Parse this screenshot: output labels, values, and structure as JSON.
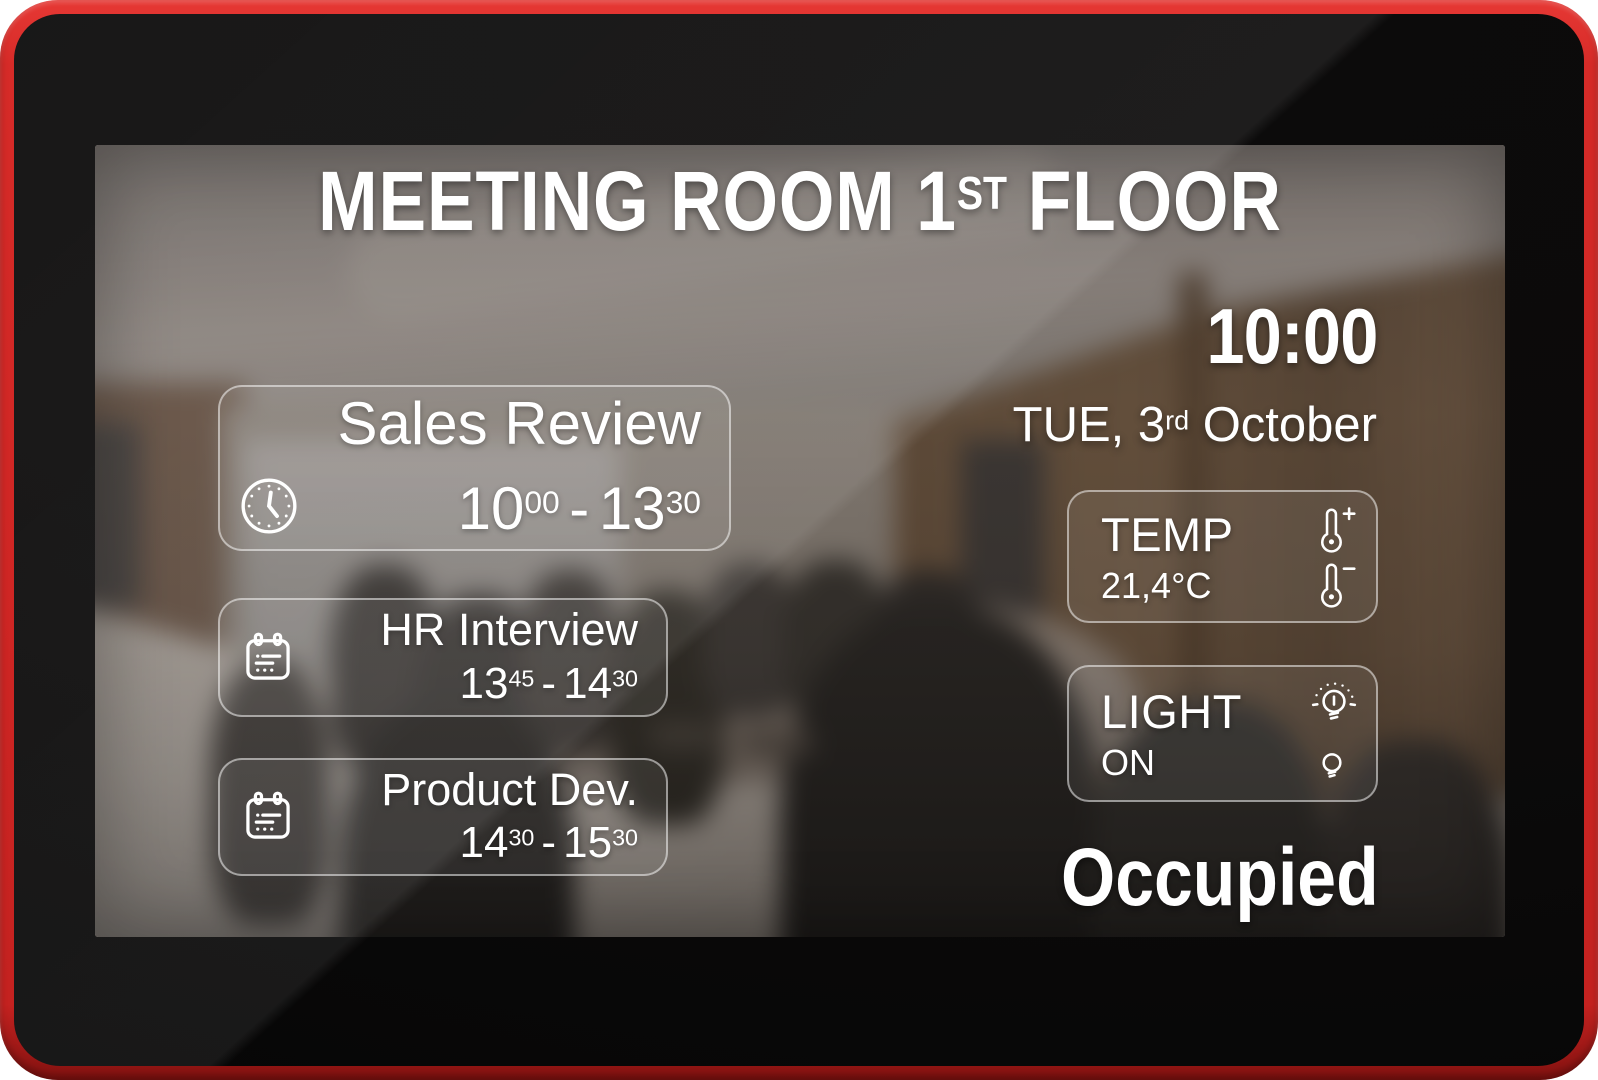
{
  "colors": {
    "frame_red": "#d42b28",
    "bezel_black": "#0b0a0a",
    "text": "#ffffff"
  },
  "header": {
    "title_prefix": "MEETING ROOM 1",
    "title_sup": "ST",
    "title_suffix": " FLOOR"
  },
  "datetime": {
    "time": "10:00",
    "date_prefix": "TUE, 3",
    "date_sup": "rd",
    "date_suffix": " October"
  },
  "meetings": [
    {
      "name": "Sales Review",
      "icon": "clock-icon",
      "start_hour": "10",
      "start_min": "00",
      "separator": "-",
      "end_hour": "13",
      "end_min": "30"
    },
    {
      "name": "HR Interview",
      "icon": "calendar-icon",
      "start_hour": "13",
      "start_min": "45",
      "separator": "-",
      "end_hour": "14",
      "end_min": "30"
    },
    {
      "name": "Product Dev.",
      "icon": "calendar-icon",
      "start_hour": "14",
      "start_min": "30",
      "separator": "-",
      "end_hour": "15",
      "end_min": "30"
    }
  ],
  "environment": {
    "temperature": {
      "label": "TEMP",
      "value": "21,4°C",
      "icons": [
        "thermometer-plus-icon",
        "thermometer-minus-icon"
      ]
    },
    "light": {
      "label": "LIGHT",
      "value": "ON",
      "icons": [
        "bulb-on-icon",
        "bulb-off-icon"
      ]
    }
  },
  "status": {
    "text": "Occupied"
  }
}
